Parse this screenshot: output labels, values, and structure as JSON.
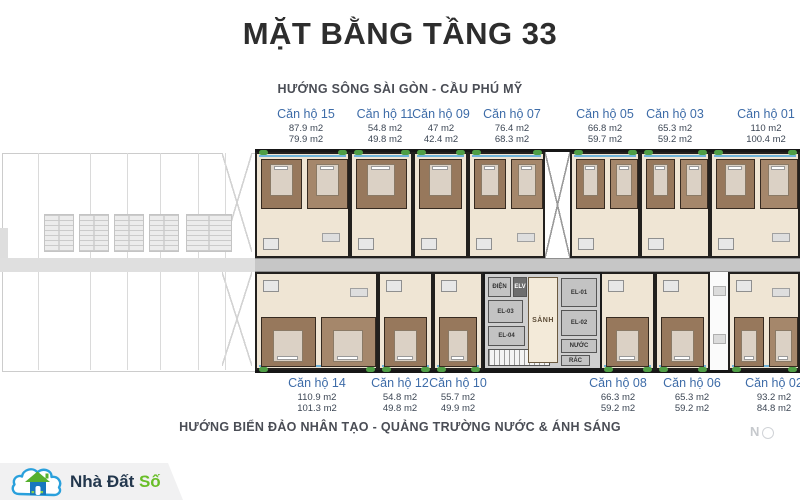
{
  "page": {
    "title": "MẶT BẰNG TẦNG 33",
    "direction_top": "HƯỚNG SÔNG SÀI GÒN - CẦU PHÚ MỸ",
    "direction_bottom": "HƯỚNG BIỂN ĐẢO NHÂN TẠO - QUẢNG TRƯỜNG NƯỚC & ÁNH SÁNG",
    "north_label": "N"
  },
  "plan": {
    "upper_units": [
      {
        "name": "Căn hộ 15",
        "area_1": "87.9 m2",
        "area_2": "79.9 m2"
      },
      {
        "name": "Căn hộ 11",
        "area_1": "54.8 m2",
        "area_2": "49.8 m2"
      },
      {
        "name": "Căn hộ 09",
        "area_1": "47 m2",
        "area_2": "42.4 m2"
      },
      {
        "name": "Căn hộ 07",
        "area_1": "76.4 m2",
        "area_2": "68.3 m2"
      },
      {
        "name": "Căn hộ 05",
        "area_1": "66.8 m2",
        "area_2": "59.7 m2"
      },
      {
        "name": "Căn hộ 03",
        "area_1": "65.3 m2",
        "area_2": "59.2 m2"
      },
      {
        "name": "Căn hộ 01",
        "area_1": "110 m2",
        "area_2": "100.4 m2"
      }
    ],
    "lower_units": [
      {
        "name": "Căn hộ 14",
        "area_1": "110.9 m2",
        "area_2": "101.3 m2"
      },
      {
        "name": "Căn hộ 12",
        "area_1": "54.8 m2",
        "area_2": "49.8 m2"
      },
      {
        "name": "Căn hộ 10",
        "area_1": "55.7 m2",
        "area_2": "49.9 m2"
      },
      {
        "name": "Căn hộ 08",
        "area_1": "66.3 m2",
        "area_2": "59.2 m2"
      },
      {
        "name": "Căn hộ 06",
        "area_1": "65.3 m2",
        "area_2": "59.2 m2"
      },
      {
        "name": "Căn hộ 02",
        "area_1": "93.2 m2",
        "area_2": "84.8 m2"
      }
    ],
    "core": {
      "dien": "ĐIỆN",
      "elv": "ELV",
      "el03": "EL-03",
      "el04": "EL-04",
      "sanh": "SẢNH",
      "el01": "EL-01",
      "el02": "EL-02",
      "nuoc": "NƯỚC",
      "rac": "RÁC"
    }
  },
  "logo": {
    "text_primary": "Nhà Đất",
    "text_accent": "Số"
  },
  "colors": {
    "unit_label_blue": "#3e6ca8",
    "heading_gray": "#4a4d55",
    "logo_navy": "#23374d",
    "logo_green": "#69be28",
    "logo_blue": "#2aa0dc",
    "plan_floor_cream": "#efe5d4",
    "bedroom_brown": "#97785c"
  }
}
